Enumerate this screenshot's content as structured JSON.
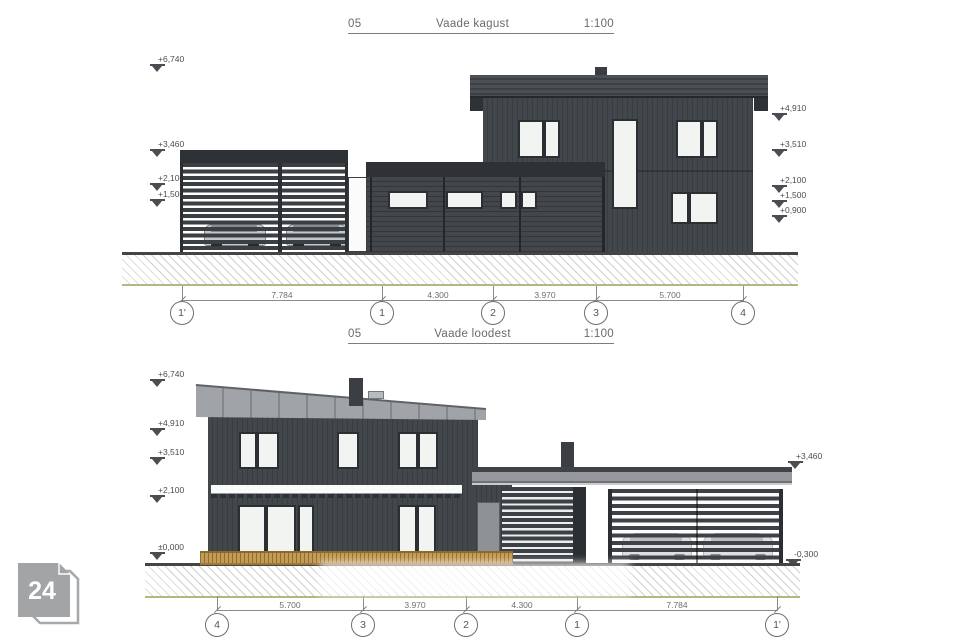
{
  "badge": {
    "label": "24"
  },
  "colors": {
    "facade_dark": "#3e4347",
    "fascia_dark": "#2e3236",
    "roof_light": "#9b9fa3",
    "deck_wood": "#c59a51",
    "ground_edge": "#b6b681",
    "marker_gray": "#4a4e52"
  },
  "top_view": {
    "title": {
      "number": "05",
      "name": "Vaade kagust",
      "scale": "1:100"
    },
    "levels_left": [
      {
        "label": "+6,740"
      },
      {
        "label": "+3,460"
      },
      {
        "label": "+2,100"
      },
      {
        "label": "+1,500"
      }
    ],
    "levels_right": [
      {
        "label": "+4,910"
      },
      {
        "label": "+3,510"
      },
      {
        "label": "+2,100"
      },
      {
        "label": "+1,500"
      },
      {
        "label": "+0,900"
      }
    ],
    "dimensions": [
      {
        "label": "7.784"
      },
      {
        "label": "4.300"
      },
      {
        "label": "3.970"
      },
      {
        "label": "5.700"
      }
    ],
    "grid_bubbles": [
      {
        "label": "1'"
      },
      {
        "label": "1"
      },
      {
        "label": "2"
      },
      {
        "label": "3"
      },
      {
        "label": "4"
      }
    ]
  },
  "bottom_view": {
    "title": {
      "number": "05",
      "name": "Vaade loodest",
      "scale": "1:100"
    },
    "levels_left": [
      {
        "label": "+6,740"
      },
      {
        "label": "+4,910"
      },
      {
        "label": "+3,510"
      },
      {
        "label": "+2,100"
      },
      {
        "label": "±0,000"
      }
    ],
    "levels_right": [
      {
        "label": "+3,460"
      },
      {
        "label": "-0,300"
      }
    ],
    "dimensions": [
      {
        "label": "5.700"
      },
      {
        "label": "3.970"
      },
      {
        "label": "4.300"
      },
      {
        "label": "7.784"
      }
    ],
    "grid_bubbles": [
      {
        "label": "4"
      },
      {
        "label": "3"
      },
      {
        "label": "2"
      },
      {
        "label": "1"
      },
      {
        "label": "1'"
      }
    ]
  }
}
